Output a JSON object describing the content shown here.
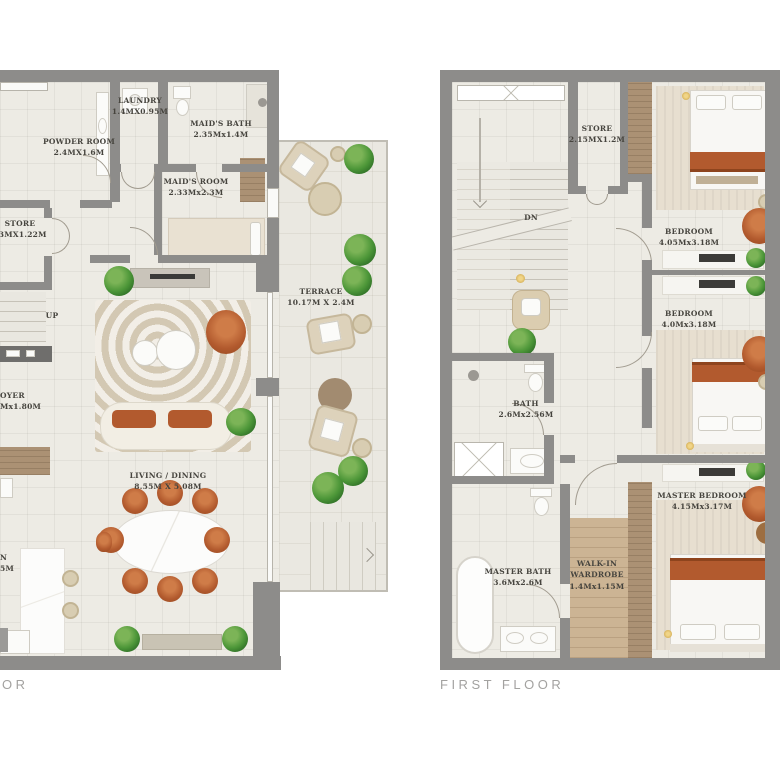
{
  "ground_floor": {
    "title": "OR",
    "stairs_label": "UP",
    "rooms": {
      "laundry": {
        "name": "LAUNDRY",
        "dims": "1.4MX0.95M"
      },
      "powder": {
        "name": "POWDER ROOM",
        "dims": "2.4MX1.6M"
      },
      "maids_bath": {
        "name": "MAID'S BATH",
        "dims": "2.35Mx1.4M"
      },
      "maids_room": {
        "name": "MAID'S ROOM",
        "dims": "2.33Mx2.3M"
      },
      "store": {
        "name": "STORE",
        "dims": "93MX1.22M"
      },
      "foyer": {
        "name": "OYER",
        "dims": "Mx1.80M"
      },
      "living": {
        "name": "LIVING / DINING",
        "dims": "8.55M X 5.08M"
      },
      "kitchen": {
        "name": "N",
        "dims": "5M"
      },
      "terrace": {
        "name": "TERRACE",
        "dims": "10.17M X 2.4M"
      }
    }
  },
  "first_floor": {
    "title": "FIRST FLOOR",
    "stairs_label": "DN",
    "rooms": {
      "store": {
        "name": "STORE",
        "dims": "2.15MX1.2M"
      },
      "bedroom1": {
        "name": "BEDROOM",
        "dims": "4.05Mx3.18M"
      },
      "bedroom2": {
        "name": "BEDROOM",
        "dims": "4.0Mx3.18M"
      },
      "bath": {
        "name": "BATH",
        "dims": "2.6Mx2.56M"
      },
      "master_bedroom": {
        "name": "MASTER BEDROOM",
        "dims": "4.15Mx3.17M"
      },
      "master_bath": {
        "name": "MASTER BATH",
        "dims": "3.6Mx2.6M"
      },
      "walkin": {
        "name_line1": "WALK-IN",
        "name_line2": "WARDROBE",
        "dims": "1.4Mx1.15M"
      }
    }
  },
  "colors": {
    "wall": "#8d8c8a",
    "floor": "#edebe4",
    "terrace_floor": "#eae8e1",
    "accent_terracotta": "#b25a2e",
    "plant_green": "#4c9638",
    "wood": "#ab9174",
    "label_text": "#46443e",
    "title_text": "#a3a2a0"
  }
}
